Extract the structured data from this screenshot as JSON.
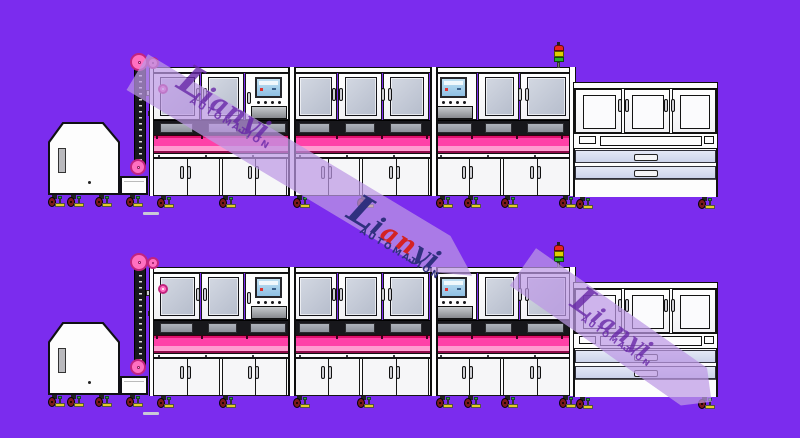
{
  "title": "automation-line-cad-drawing",
  "watermark": {
    "brand": "Lianyi",
    "tagline": "AUTOMATION",
    "colored_letters": [
      {
        "ch": "L",
        "c": "navy"
      },
      {
        "ch": "i",
        "c": "navy"
      },
      {
        "ch": "a",
        "c": "red"
      },
      {
        "ch": "n",
        "c": "red"
      },
      {
        "ch": "y",
        "c": "navy"
      },
      {
        "ch": "i",
        "c": "navy"
      }
    ]
  },
  "colors": {
    "bg": "#7B2CEE",
    "line": "#141418",
    "white": "#fdfdfd",
    "doorFace": "#f6f6f8",
    "glass": "#c6ccd8",
    "pinkMain": "#ff41a8",
    "pinkLight": "#ff9bd0",
    "pinkDeep": "#e0136e",
    "pinkDark": "#8f0a49",
    "pulley": "#ff70c1",
    "pulleyRing": "#c2247e",
    "recess": "#17171b",
    "slabTop": "#aeb3bb",
    "slabBottom": "#8d929b",
    "drawerTop": "#e4e8f6",
    "drawerBottom": "#ccd3ea",
    "screenTop": "#bfe0f2",
    "screenBottom": "#8fc0e4",
    "trayTop": "#c7cacd",
    "trayBottom": "#87898d",
    "casterWheel": "#7c1a1a",
    "foot": "#e3cd25",
    "footGreen": "#2fae2f",
    "lightRed": "#e82420",
    "lightYellow": "#ddd000",
    "lightGreen": "#27b427",
    "bandFill": "rgba(189,152,228,0.72)",
    "ghost": "rgba(104,40,168,0.8)",
    "logoNavy": "#30307f",
    "logoRed": "#d42222",
    "dash": "#c9c9d6"
  },
  "machine_rows": [
    {
      "label": "machine-row-top",
      "top": 45
    },
    {
      "label": "machine-row-bottom",
      "top": 245
    }
  ],
  "layout": {
    "hopper": {
      "body": [
        48,
        77,
        72,
        73
      ],
      "slot": [
        58,
        103,
        8,
        25
      ],
      "ext": [
        120,
        131,
        28,
        19
      ],
      "dot": [
        88,
        136
      ],
      "casters": [
        48,
        67,
        95,
        126
      ],
      "casterY": 150
    },
    "elevator": {
      "chain": [
        134,
        17,
        12,
        106
      ],
      "rail": [
        156,
        27,
        4,
        96
      ],
      "pulleys": [
        [
          139,
          17,
          9
        ],
        [
          153,
          18,
          6
        ],
        [
          138,
          122,
          8
        ]
      ],
      "brackets": [
        [
          146,
          45,
          16,
          6
        ],
        [
          148,
          66,
          10,
          5
        ]
      ]
    },
    "mainline": {
      "topRail": [
        150,
        22,
        425,
        6
      ],
      "upper_units": [
        {
          "type": "door",
          "x": 153,
          "w": 47
        },
        {
          "type": "door",
          "x": 201,
          "w": 43
        },
        {
          "type": "hmi",
          "x": 245,
          "w": 46
        },
        {
          "type": "door",
          "x": 292,
          "w": 45
        },
        {
          "type": "door",
          "x": 338,
          "w": 44
        },
        {
          "type": "door",
          "x": 383,
          "w": 46
        },
        {
          "type": "hmi",
          "x": 430,
          "w": 47
        },
        {
          "type": "door",
          "x": 478,
          "w": 41
        },
        {
          "type": "door",
          "x": 520,
          "w": 51
        }
      ],
      "upper_handles": [
        196,
        332,
        381,
        518
      ],
      "recess": [
        153,
        75,
        418,
        15
      ],
      "pink_band": [
        150,
        90,
        425,
        18
      ],
      "white_rail": [
        150,
        108,
        425,
        5
      ],
      "lower_cabinets": [
        {
          "x": 153,
          "w": 67
        },
        {
          "x": 222,
          "w": 65
        },
        {
          "x": 295,
          "w": 65
        },
        {
          "x": 362,
          "w": 67
        },
        {
          "x": 436,
          "w": 65
        },
        {
          "x": 503,
          "w": 67
        }
      ],
      "lower_box": [
        152,
        113,
        419,
        38
      ],
      "bay_frames": [
        288,
        430
      ],
      "end_frames": [
        [
          149,
          5
        ],
        [
          569,
          7
        ]
      ],
      "casters": [
        157,
        219,
        293,
        357,
        436,
        464,
        501,
        559
      ],
      "casterY": 151,
      "knob": [
        163,
        44
      ],
      "dash": [
        143,
        167,
        16,
        3
      ]
    },
    "stack_light": {
      "x": 554,
      "y": 0
    },
    "station": {
      "box": [
        573,
        37,
        145,
        115
      ],
      "topRail": [
        573,
        37,
        145,
        7
      ],
      "doors": [
        {
          "x": 575,
          "w": 47
        },
        {
          "x": 624,
          "w": 46
        },
        {
          "x": 672,
          "w": 44
        }
      ],
      "doorY": 44,
      "doorH": 44,
      "handles": [
        618,
        664
      ],
      "band": [
        573,
        88,
        145,
        16
      ],
      "band_inners": [
        [
          579,
          91,
          17,
          8
        ],
        [
          600,
          91,
          102,
          10
        ],
        [
          704,
          91,
          10,
          8
        ]
      ],
      "drawers": [
        [
          575,
          105,
          141,
          13
        ],
        [
          575,
          121,
          141,
          13
        ]
      ],
      "bottom": [
        575,
        134,
        141,
        18
      ],
      "casters": [
        576,
        698
      ],
      "casterY": 152
    }
  }
}
